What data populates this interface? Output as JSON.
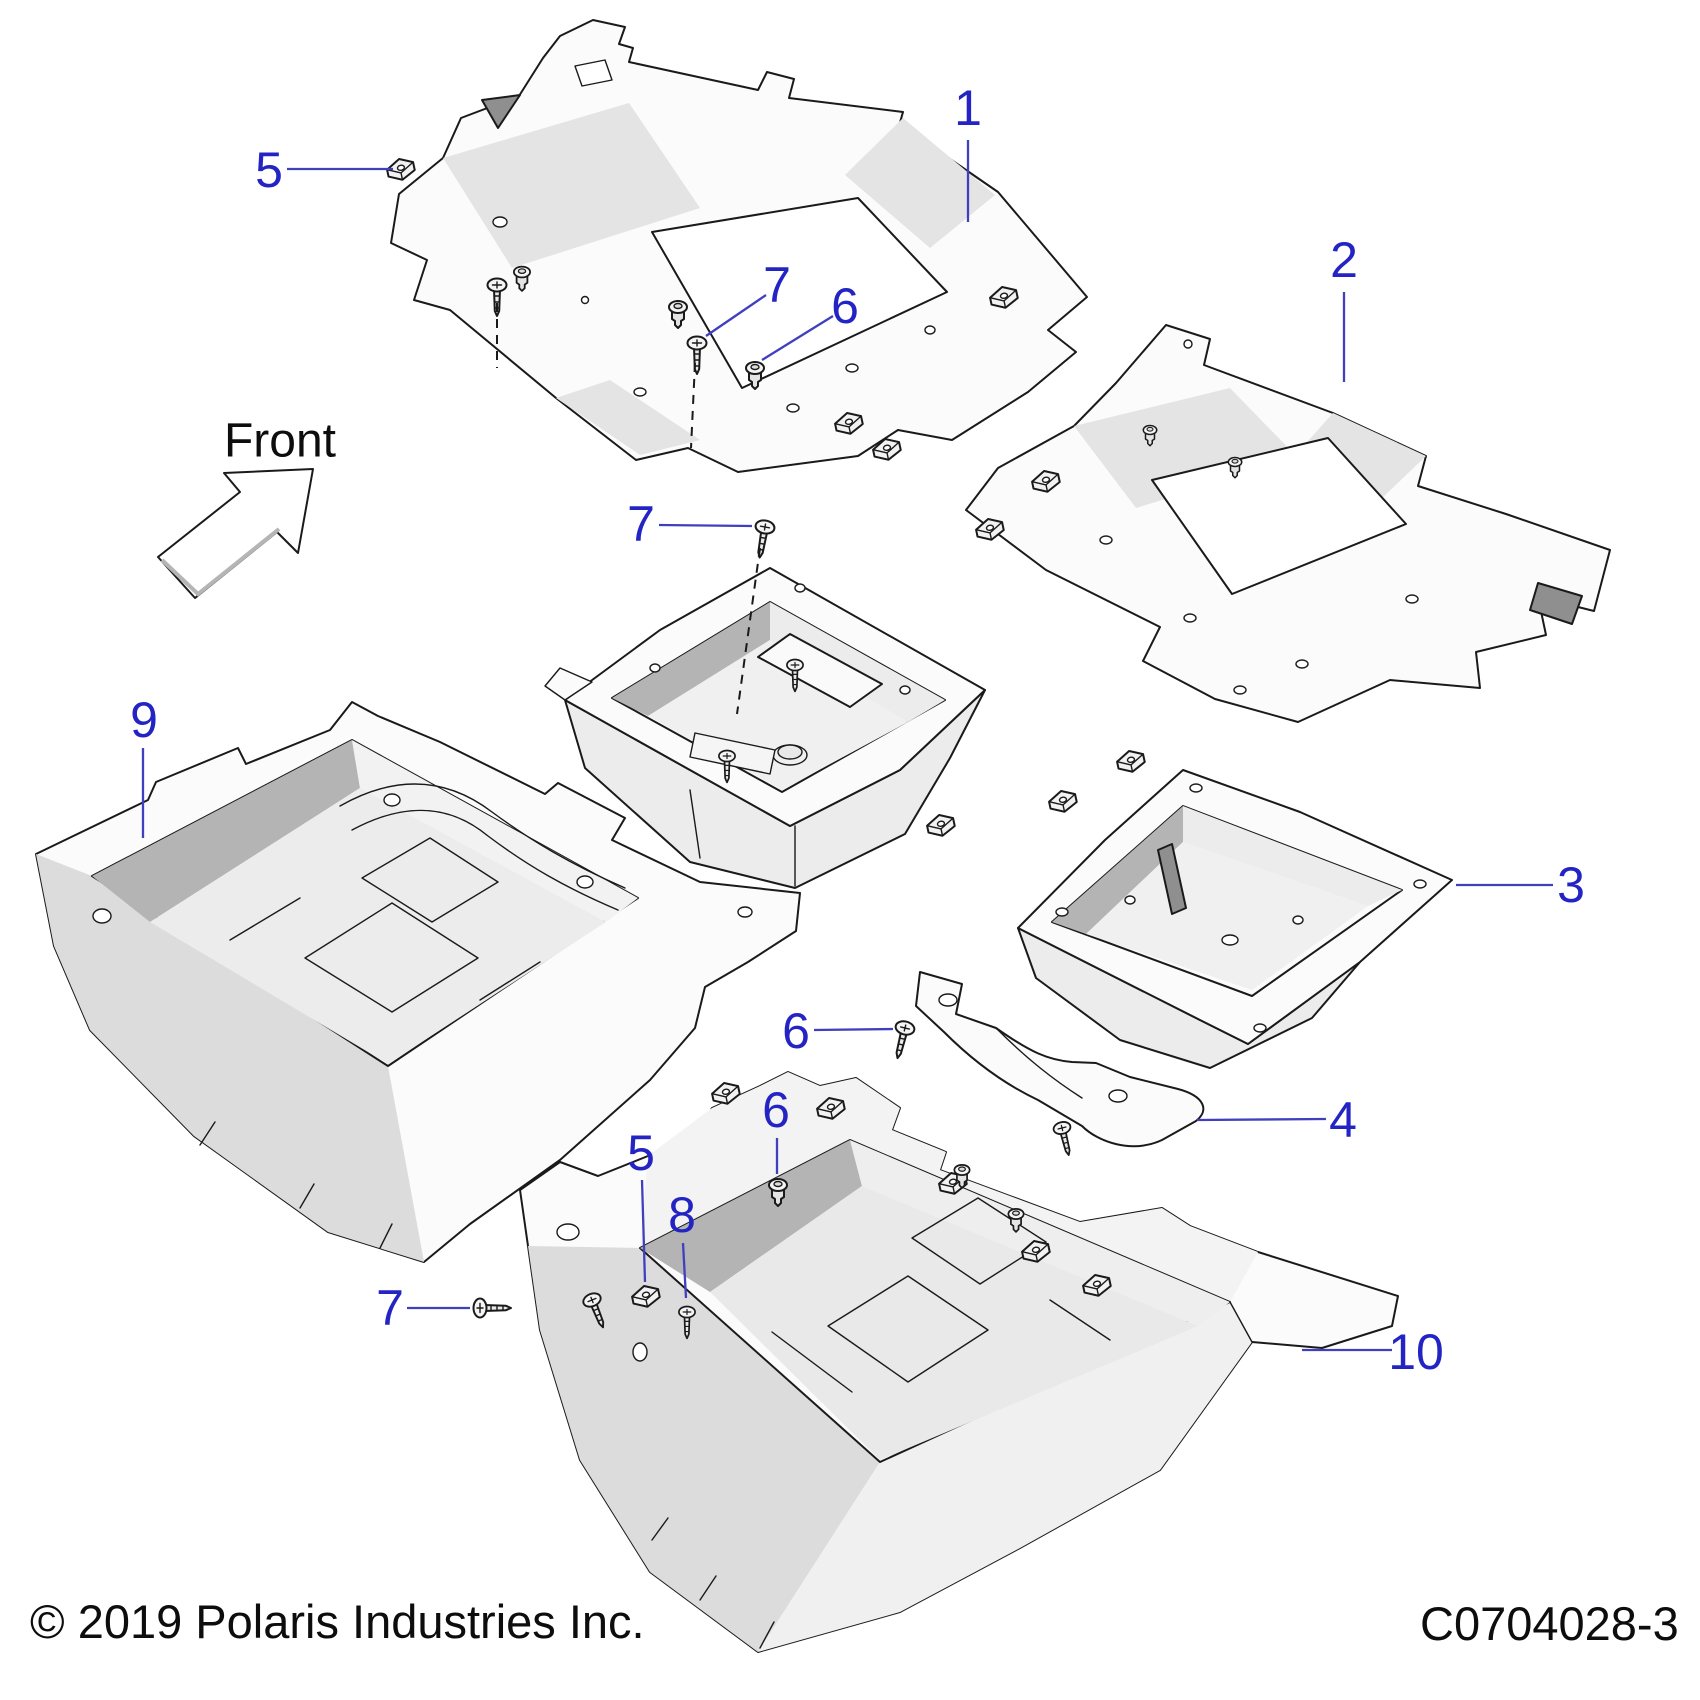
{
  "diagram": {
    "front_label": "Front",
    "copyright": "© 2019 Polaris Industries Inc.",
    "part_code": "C0704028-3",
    "accent_color": "#2424c4",
    "line_color": "#1a1a1a",
    "callouts": [
      {
        "id": "1",
        "label": "1"
      },
      {
        "id": "2",
        "label": "2"
      },
      {
        "id": "3",
        "label": "3"
      },
      {
        "id": "4",
        "label": "4"
      },
      {
        "id": "5-top",
        "label": "5"
      },
      {
        "id": "7-panel1",
        "label": "7"
      },
      {
        "id": "6-panel1",
        "label": "6"
      },
      {
        "id": "7-bin",
        "label": "7"
      },
      {
        "id": "9",
        "label": "9"
      },
      {
        "id": "6-mid",
        "label": "6"
      },
      {
        "id": "6-lower",
        "label": "6"
      },
      {
        "id": "5-lower",
        "label": "5"
      },
      {
        "id": "8",
        "label": "8"
      },
      {
        "id": "7-bottom",
        "label": "7"
      },
      {
        "id": "10",
        "label": "10"
      }
    ]
  }
}
